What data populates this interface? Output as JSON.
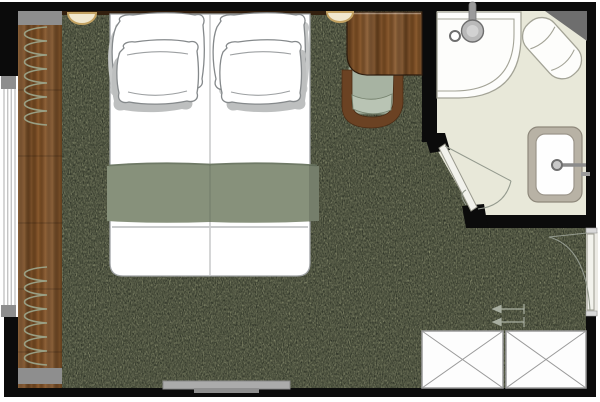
{
  "drawing": {
    "type": "floor-plan",
    "subject": "hotel-guestroom-with-ensuite-bathroom",
    "visible_text": []
  },
  "colors": {
    "wall": "#0b0b0b",
    "carpet_base": "#2c3126",
    "carpet_fleck": "#6e7444",
    "wood_light": "#8a5a2e",
    "wood_mid": "#7b4e26",
    "wood_dark": "#5d3a1b",
    "headboard": "#33200f",
    "bathroom_floor": "#e8e8d9",
    "fixture_white": "#fdfdfb",
    "fixture_outline": "#a3a396",
    "counter": "#b8b2a5",
    "runner": "#87917b",
    "chair_seat": "#a7b3a2",
    "chair_wood": "#6b4223",
    "lamp_glow": "#f1e8cf",
    "lamp_rim": "#c3a262",
    "glass_line": "#c4c4c4",
    "block_gray": "#8e8e8e",
    "door_leaf": "#f2f2ec",
    "swing_line": "#949a8e",
    "tv_gray": "#ababab",
    "triangle_gray": "#6e6e6e"
  },
  "rooms": {
    "bedroom": {
      "floor": "dark-olive-carpet",
      "furniture": [
        {
          "name": "double-bed",
          "parts": [
            "two-mattress-halves",
            "four-pillows",
            "sage-bed-runner"
          ]
        },
        {
          "name": "reading-light-left"
        },
        {
          "name": "reading-light-right"
        },
        {
          "name": "desk"
        },
        {
          "name": "desk-chair"
        },
        {
          "name": "wall-mounted-tv"
        },
        {
          "name": "wardrobe-unit",
          "sections": 2,
          "symbol": "crossed-box"
        },
        {
          "name": "curtain-coil-top"
        },
        {
          "name": "curtain-coil-bottom"
        },
        {
          "name": "window-wall"
        },
        {
          "name": "wood-floor-border"
        }
      ]
    },
    "bathroom": {
      "floor": "light-stone-tile",
      "fixtures": [
        {
          "name": "corner-shower",
          "shape": "quarter-circle"
        },
        {
          "name": "shower-head"
        },
        {
          "name": "shower-control"
        },
        {
          "name": "toilet",
          "orientation": "diagonal-corner"
        },
        {
          "name": "corner-shelf"
        },
        {
          "name": "vanity-counter"
        },
        {
          "name": "sink-basin"
        },
        {
          "name": "faucet"
        },
        {
          "name": "bathroom-door",
          "placement": "chamfered-corner",
          "swing": "inward"
        }
      ]
    },
    "entry": {
      "features": [
        {
          "name": "entry-door",
          "wall": "right",
          "swing": "inward"
        },
        {
          "name": "threshold-markers",
          "count": 2
        }
      ]
    }
  }
}
